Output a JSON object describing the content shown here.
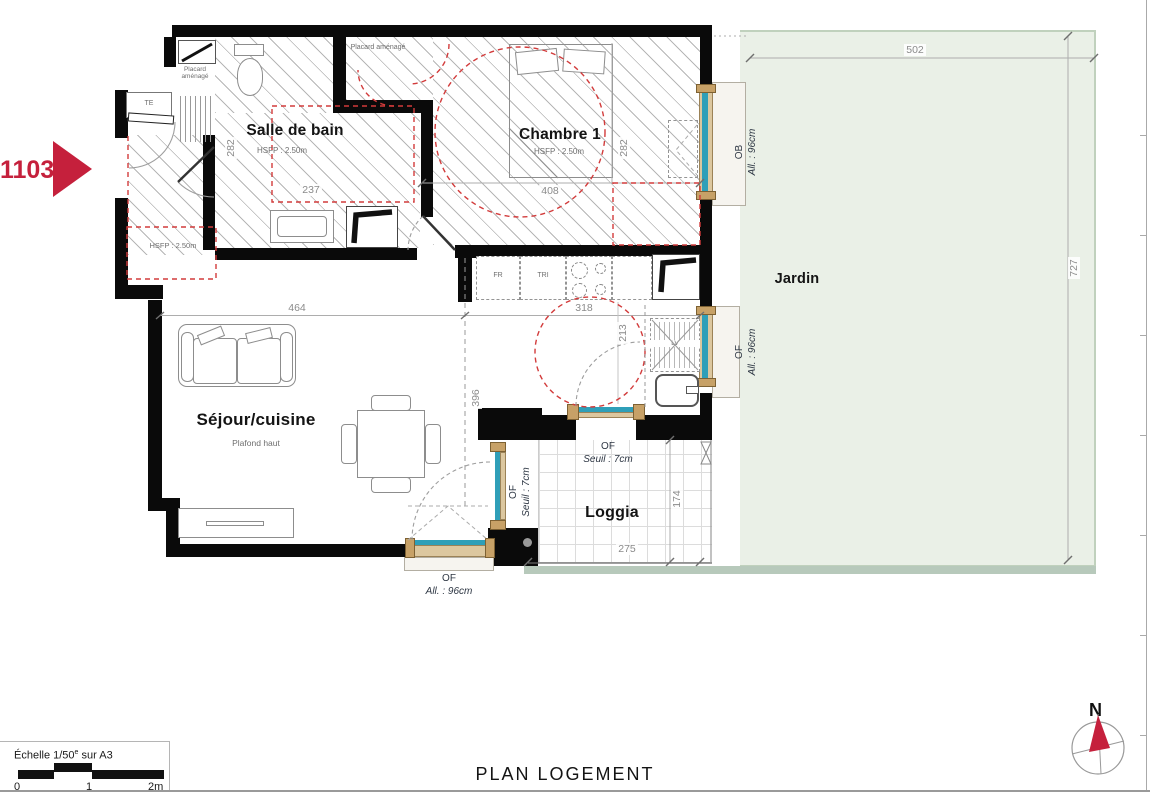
{
  "title": "PLAN LOGEMENT",
  "unit": {
    "number": "1103"
  },
  "compass": {
    "north": "N"
  },
  "scalebar": {
    "prefix": "Échelle 1/50",
    "sup": "e",
    "suffix": " sur A3",
    "t0": "0",
    "t1": "1",
    "t2": "2m"
  },
  "rooms": {
    "entry": {
      "height": "HSFP : 2.50m"
    },
    "bathroom": {
      "name": "Salle de bain",
      "height": "HSFP : 2.50m"
    },
    "bedroom": {
      "name": "Chambre 1",
      "height": "HSFP : 2.50m"
    },
    "living": {
      "name": "Séjour/cuisine",
      "note": "Plafond haut"
    },
    "loggia": {
      "name": "Loggia"
    },
    "garden": {
      "name": "Jardin"
    }
  },
  "closets": {
    "entry": "Placard aménagé",
    "bedroom": "Placard aménagé"
  },
  "equipment": {
    "te": "TE",
    "fridge": "FR",
    "sorting": "TRI",
    "dishwasher": "LV"
  },
  "windows": {
    "ob_bedroom": {
      "code": "OB",
      "detail": "All. : 96cm"
    },
    "of_kitchen": {
      "code": "OF",
      "detail": "All. : 96cm"
    },
    "of_loggia_top": {
      "code": "OF",
      "detail": "Seuil : 7cm"
    },
    "of_loggia_side": {
      "code": "OF",
      "detail": "Seuil : 7cm"
    },
    "of_living_bottom": {
      "code": "OF",
      "detail": "All. : 96cm"
    }
  },
  "dimensions": {
    "garden_w": "502",
    "garden_h": "727",
    "living_w": "464",
    "kitchen_w": "318",
    "kitchen_h": "396",
    "bath_h": "282",
    "bath_w": "237",
    "bedroom_w": "408",
    "bedroom_h": "282",
    "kitchen_pass": "213",
    "loggia_w": "275",
    "loggia_h": "174"
  },
  "colors": {
    "accent": "#c5203c",
    "garden": "#eaf0e7",
    "glass": "#2f9fb8",
    "frame": "#dcc79f",
    "wall": "#0a0a0a"
  }
}
